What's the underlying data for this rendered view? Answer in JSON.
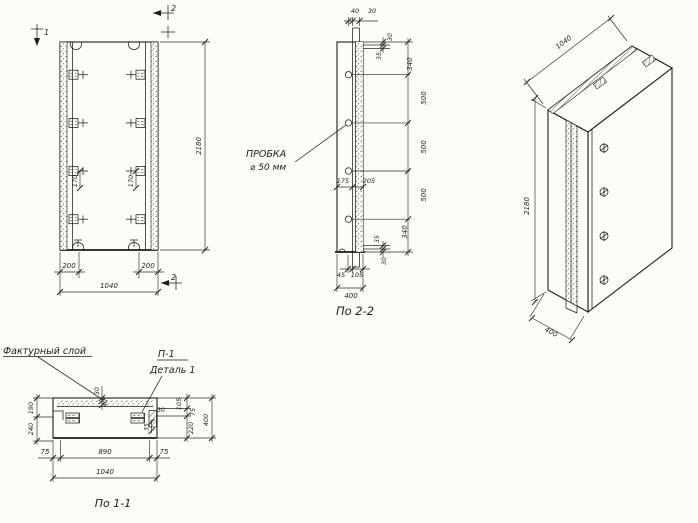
{
  "drawing": {
    "paper_color": "#fcfcfa",
    "ink_color": "#1d1d1d",
    "front_view": {
      "section_marks": {
        "cut1": "1",
        "cut2_top": "2",
        "cut2_bottom": "2"
      },
      "dims": {
        "height": "2180",
        "width": "1040",
        "rib_left": "200",
        "rib_right": "200",
        "anchor_pitch_left": "170",
        "anchor_pitch_right": "170"
      }
    },
    "section_2_2": {
      "caption": "По 2-2",
      "plug_label_line1": "ПРОБКА",
      "plug_label_line2": "⌀ 50 мм",
      "dims": {
        "top_a": "40",
        "top_b": "30",
        "edge_top_a": "30",
        "edge_top_b": "35",
        "chain": [
          "340",
          "500",
          "500",
          "500",
          "340"
        ],
        "edge_bottom_a": "35",
        "edge_bottom_b": "30",
        "mid_a": "175",
        "mid_b": "205",
        "bottom_a": "45",
        "bottom_b": "105",
        "depth": "400"
      }
    },
    "iso_view": {
      "dims": {
        "width": "1040",
        "height": "2180",
        "depth": "400"
      }
    },
    "section_1_1": {
      "caption": "По 1-1",
      "labels": {
        "texture_layer": "Фактурный слой",
        "detail_ref": "П-1",
        "detail_name": "Деталь 1"
      },
      "dims": {
        "left_a": "190",
        "left_b": "240",
        "center_a": "30",
        "center_b": "40",
        "right_small_a": "30",
        "right_small_b": "35",
        "chain": [
          "105",
          "75",
          "220"
        ],
        "depth": "400",
        "bottom_left": "75",
        "bottom_center": "890",
        "bottom_right": "75",
        "width": "1040"
      }
    }
  }
}
